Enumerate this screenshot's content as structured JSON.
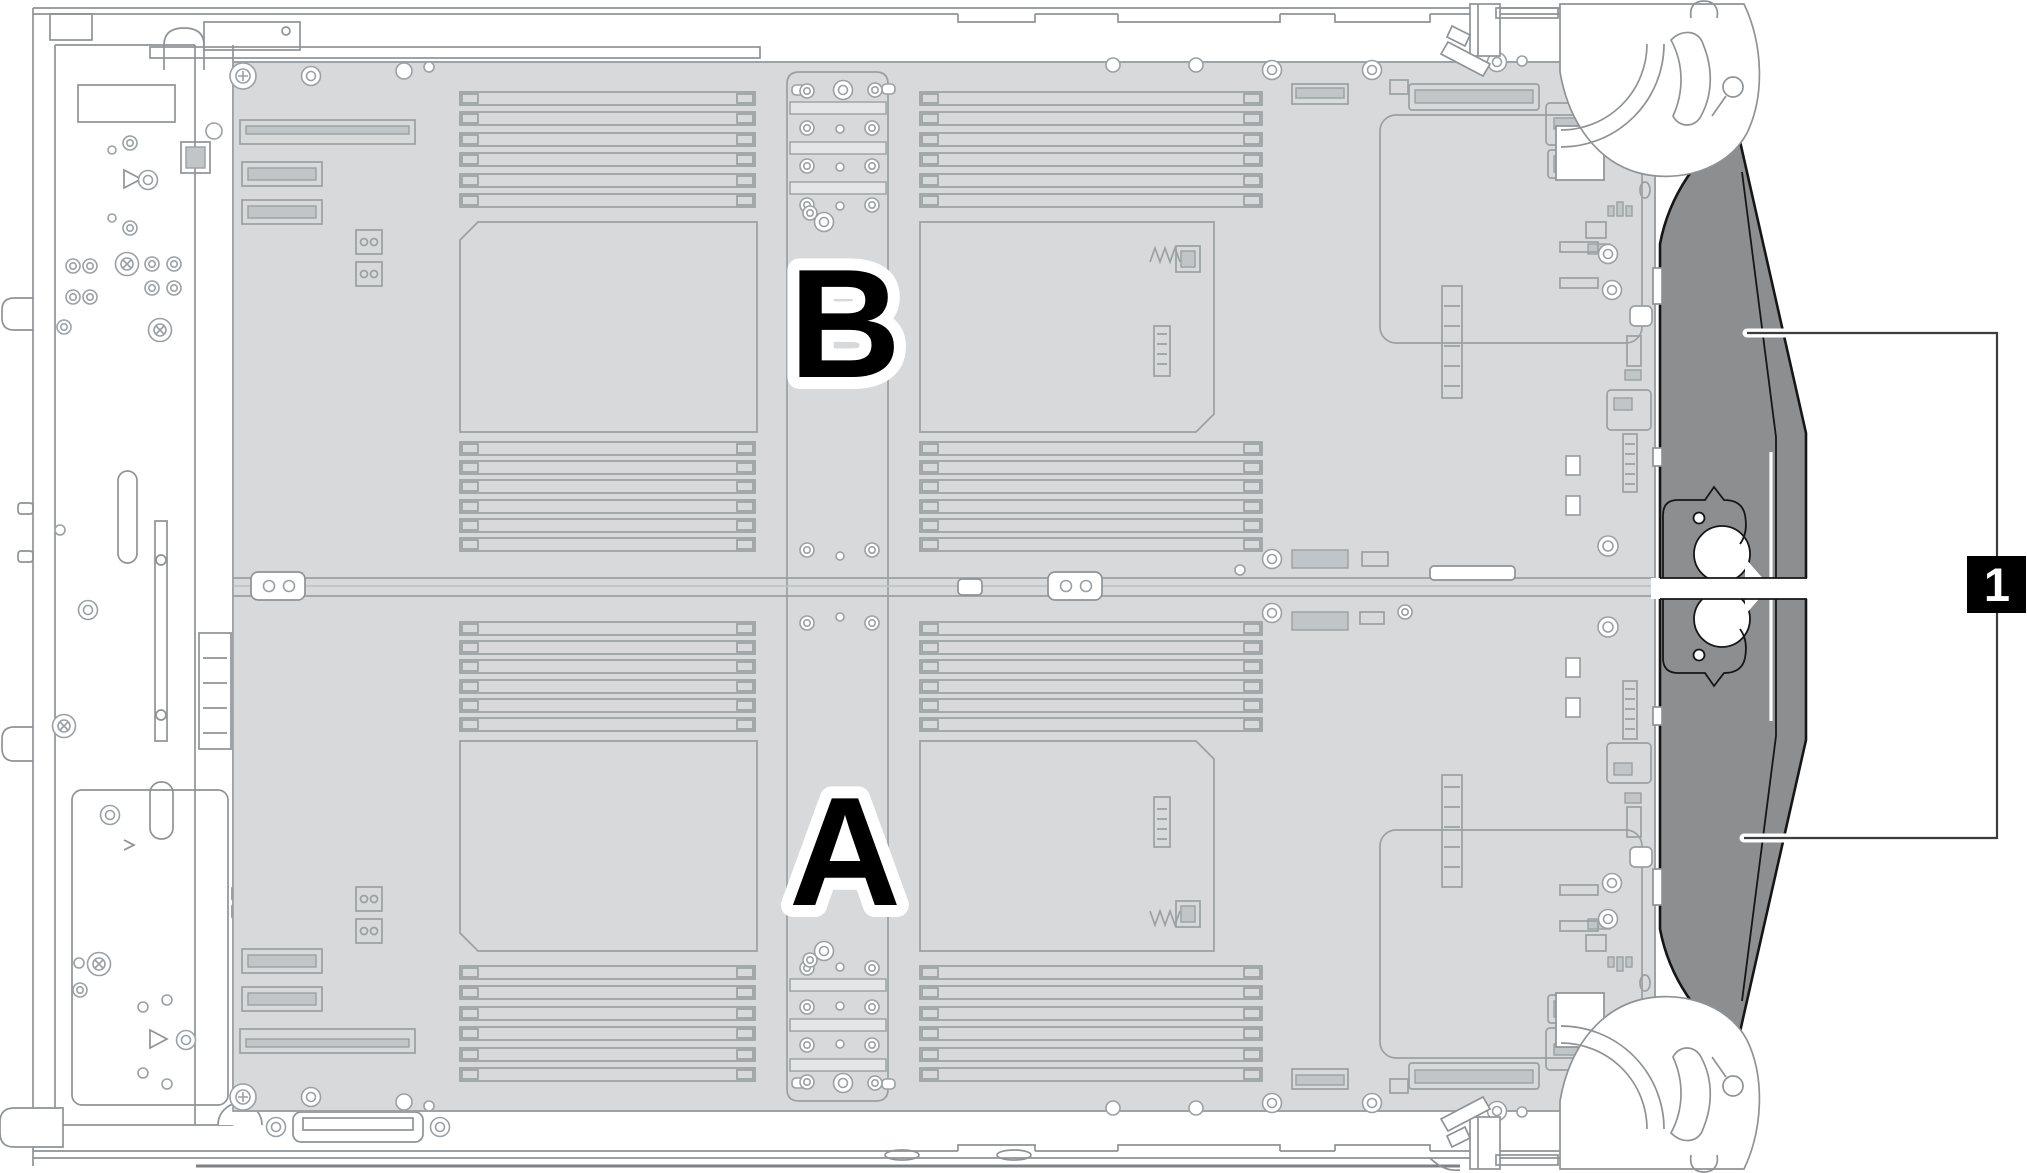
{
  "figure": {
    "node_b_label": "B",
    "node_a_label": "A",
    "callout_label": "1"
  },
  "colors": {
    "board_fill": "#d8d9da",
    "board_line": "#9aa0a3",
    "chassis_line": "#8f9396",
    "inner_fill": "#c2c5c7",
    "bar_fill": "#e4e5e6",
    "baffle_fill": "#8d8e90",
    "outline_dark": "#161616",
    "leader_line": "#3c3c3c",
    "badge_bg": "#000000",
    "badge_fg": "#ffffff",
    "label_fill": "#000000",
    "label_halo": "#ffffff"
  }
}
